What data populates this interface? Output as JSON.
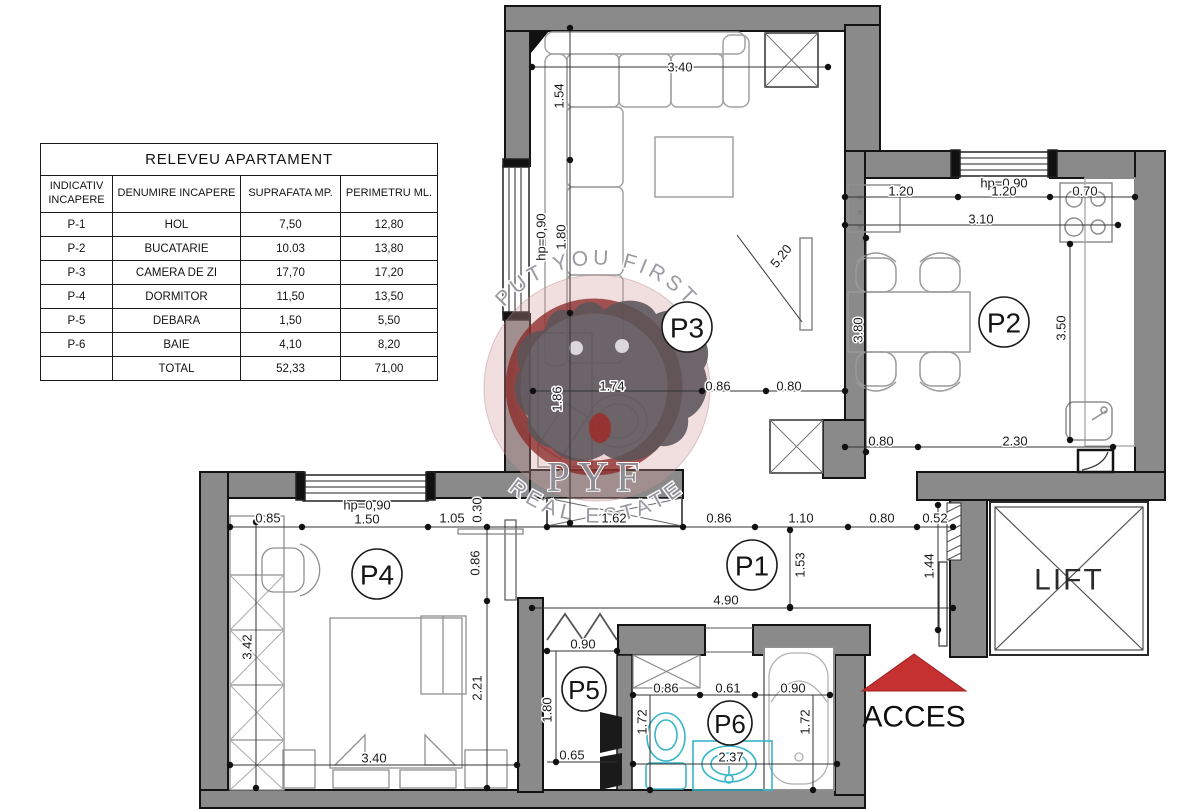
{
  "table": {
    "title": "RELEVEU APARTAMENT",
    "headers": [
      "INDICATIV INCAPERE",
      "DENUMIRE INCAPERE",
      "SUPRAFATA MP.",
      "PERIMETRU ML."
    ],
    "rows": [
      {
        "id": "P-1",
        "name": "HOL",
        "area": "7,50",
        "perimeter": "12,80"
      },
      {
        "id": "P-2",
        "name": "BUCATARIE",
        "area": "10.03",
        "perimeter": "13,80"
      },
      {
        "id": "P-3",
        "name": "CAMERA DE ZI",
        "area": "17,70",
        "perimeter": "17,20"
      },
      {
        "id": "P-4",
        "name": "DORMITOR",
        "area": "11,50",
        "perimeter": "13,50"
      },
      {
        "id": "P-5",
        "name": "DEBARA",
        "area": "1,50",
        "perimeter": "5,50"
      },
      {
        "id": "P-6",
        "name": "BAIE",
        "area": "4,10",
        "perimeter": "8,20"
      },
      {
        "id": "",
        "name": "TOTAL",
        "area": "52,33",
        "perimeter": "71,00"
      }
    ]
  },
  "plan": {
    "room_labels": {
      "p1": "P1",
      "p2": "P2",
      "p3": "P3",
      "p4": "P4",
      "p5": "P5",
      "p6": "P6"
    },
    "lift_label": "LIFT",
    "access_label": "ACCES",
    "symbols": {
      "frost_mark": "*"
    },
    "watermark": {
      "arc_top": "PUT YOU FIRST",
      "monogram": "PYF",
      "arc_bottom": "REAL ESTATE"
    },
    "dims": {
      "p3_width": "3.40",
      "p3_sofa_depth": "1.54",
      "p3_hp": "hp=0,90",
      "p3_window_h": "1.80",
      "p3_diag": "5.20",
      "p3_desk_len": "1.86",
      "p3_desk_w": "1.74",
      "p3_gap_a": "0.86",
      "p3_gap_b": "0.80",
      "p2_hp": "hp=0,90",
      "p2_win_a": "1.20",
      "p2_win_b": "1.20",
      "p2_width": "3.10",
      "p2_stove": "0.70",
      "p2_left_h": "3.80",
      "p2_right_h": "3.50",
      "p2_bottom_a": "0.80",
      "p2_bottom_b": "2.30",
      "band_a": "0.85",
      "p4_hp": "hp=0,90",
      "band_b": "1.50",
      "band_c": "1.05",
      "band_d": "0.30",
      "band_e": "1.62",
      "band_f": "0.86",
      "band_g": "1.10",
      "band_h": "0.80",
      "band_i": "0.52",
      "entry_door": "1.44",
      "p1_depth": "1.53",
      "p1_width": "4.90",
      "p4_door": "0.86",
      "p4_side": "2.21",
      "p4_wardrobe": "3.42",
      "p4_width": "3.40",
      "p5_width": "0.90",
      "p5_depth": "1.80",
      "p5_bottom": "0.65",
      "p6_a": "0.86",
      "p6_b": "0.61",
      "p6_c": "0.90",
      "p6_left_h": "1.72",
      "p6_tub_h": "1.72",
      "p6_width": "2.37"
    },
    "colors": {
      "wall": "#8a8a8a",
      "outline": "#141414",
      "furniture": "#909090",
      "fixture_cyan": "#39b6c9",
      "access_red": "#c53030",
      "watermark_red": "#8f2f2f",
      "dim_text": "#1b1b1b"
    }
  }
}
